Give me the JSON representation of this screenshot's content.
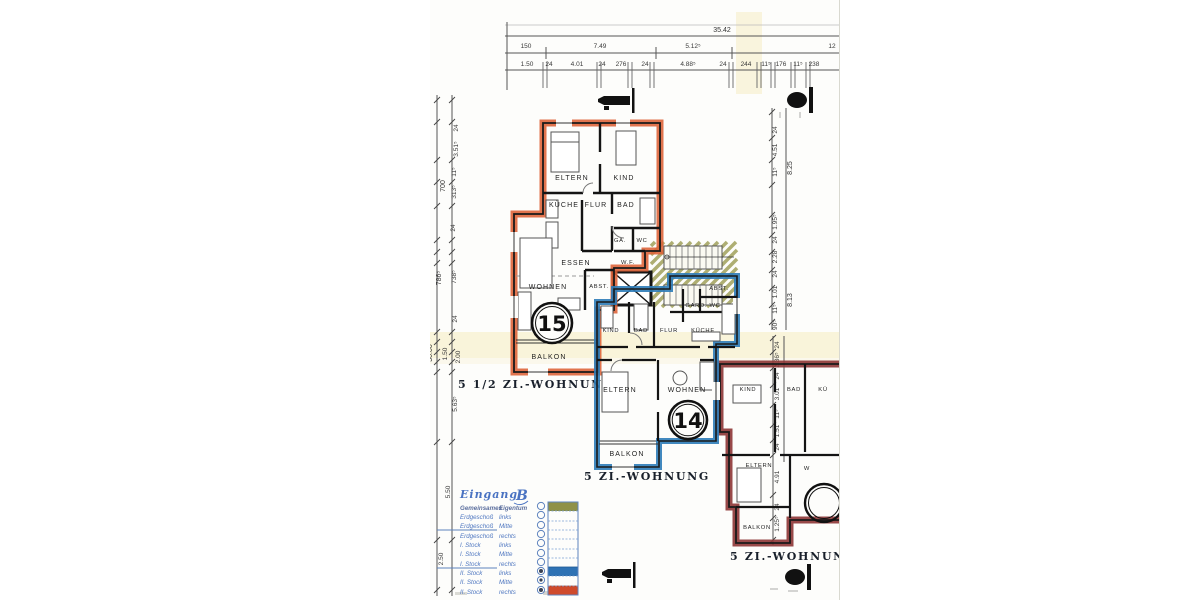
{
  "drawing": {
    "unit15": {
      "number": "15",
      "title": "5 1/2 ZI.-WOHNUNG",
      "color": "#dd6136",
      "rooms": {
        "eltern": "ELTERN",
        "kind": "KIND",
        "kueche": "KÜCHE",
        "flur": "FLUR",
        "bad": "BAD",
        "ga": "GA.",
        "wc": "WC",
        "essen": "ESSEN",
        "wf": "W.F.",
        "wohnen": "WOHNEN",
        "abst": "ABST.",
        "balkon": "BALKON"
      }
    },
    "unit14": {
      "number": "14",
      "title": "5 ZI.-WOHNUNG",
      "color": "#2e7cb8",
      "rooms": {
        "kind": "KIND",
        "bad": "BAD",
        "flur": "FLUR",
        "kueche": "KÜCHE",
        "abst": "ABST.",
        "gard_wc": "GARD. WC",
        "eltern": "ELTERN",
        "wohnen": "WOHNEN",
        "balkon": "BALKON"
      }
    },
    "unit13": {
      "number": "",
      "title": "5 ZI.-WOHNUNG",
      "color": "#8d3535",
      "rooms": {
        "kind": "KIND",
        "bad": "BAD",
        "kueche": "KÜ",
        "eltern": "ELTERN",
        "wohnen": "W",
        "balkon": "BALKON"
      }
    }
  },
  "dimensions": {
    "top": {
      "total": "35.42",
      "segments": [
        "150",
        "7.49",
        "5.12⁵",
        "12"
      ],
      "detail": [
        "1.50",
        "24",
        "4.01",
        "24",
        "276",
        "24",
        "4.88⁵",
        "24",
        "244",
        "11⁵",
        "176",
        "11⁵",
        "238"
      ]
    },
    "left": {
      "totals": [
        "700",
        "786⁵",
        "30.00"
      ],
      "detail": [
        "24",
        "3.51⁵",
        "11⁵",
        "313⁵",
        "24",
        "738⁵",
        "24",
        "1.50",
        "2.00",
        "5.63⁵",
        "5.50",
        "2.50"
      ]
    },
    "right": {
      "totals": [
        "8.25",
        "8.13"
      ],
      "detail": [
        "24",
        "4.51",
        "11⁵",
        "1.95⁵",
        "24",
        "2.28",
        "24",
        "1.01",
        "11⁵",
        "90⁵"
      ],
      "detail2": [
        "24",
        "2.36⁵",
        "24",
        "3.01",
        "11⁵",
        "1.51",
        "24",
        "4.91",
        "24",
        "1.25⁵"
      ]
    }
  },
  "legend": {
    "title": "Eingang",
    "entrance": "B",
    "rows": [
      {
        "left": "Gemeinsames",
        "right": "Eigentum",
        "swatch": "#8f9147"
      },
      {
        "left": "Erdgeschoß",
        "right": "links",
        "swatch": "#fdfdfb"
      },
      {
        "left": "Erdgeschoß",
        "right": "Mitte",
        "swatch": "#fdfdfb"
      },
      {
        "left": "Erdgeschoß",
        "right": "rechts",
        "swatch": "#fdfdfb"
      },
      {
        "left": "I. Stock",
        "right": "links",
        "swatch": "#fdfdfb"
      },
      {
        "left": "I. Stock",
        "right": "Mitte",
        "swatch": "#fdfdfb"
      },
      {
        "left": "I. Stock",
        "right": "rechts",
        "swatch": "#fdfdfb"
      },
      {
        "left": "II. Stock",
        "right": "links",
        "swatch": "#2e72b4"
      },
      {
        "left": "II. Stock",
        "right": "Mitte",
        "swatch": "#fdfdfb"
      },
      {
        "left": "II. Stock",
        "right": "rechts",
        "swatch": "#cf4a2b"
      }
    ]
  }
}
